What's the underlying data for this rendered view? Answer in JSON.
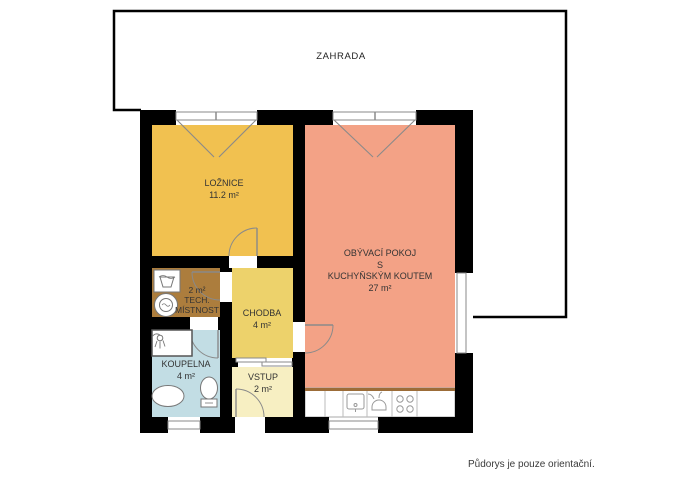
{
  "plan": {
    "note": "Půdorys je pouze orientační.",
    "garden": {
      "name": "ZAHRADA"
    },
    "rooms": {
      "loznice": {
        "name": "LOŽNICE",
        "area": "11.2 m²",
        "color": "#f1c150"
      },
      "obyvaci_pokoj": {
        "name_line1": "OBÝVACÍ POKOJ",
        "name_line2": "S",
        "name_line3": "KUCHYŇSKÝM KOUTEM",
        "area": "27 m²",
        "color": "#f3a286"
      },
      "tech_mistnost": {
        "area": "2 m²",
        "name_line1": "TECH.",
        "name_line2": "MÍSTNOST",
        "color": "#ac7d3d"
      },
      "chodba": {
        "name": "CHODBA",
        "area": "4 m²",
        "color": "#edd26b"
      },
      "koupelna": {
        "name": "KOUPELNA",
        "area": "4 m²",
        "color": "#c2dde4"
      },
      "vstup": {
        "name": "VSTUP",
        "area": "2 m²",
        "color": "#f7efc2"
      }
    },
    "colors": {
      "wall": "#000000",
      "window_frame": "#8a8a8a",
      "counter_edge": "#9c6c38"
    },
    "fixtures": [
      "laundry-basket-icon",
      "washing-machine-icon",
      "shower-icon",
      "bathroom-sink-icon",
      "toilet-icon",
      "kitchen-sink-icon",
      "stove-icon",
      "cooktop-icon"
    ]
  }
}
